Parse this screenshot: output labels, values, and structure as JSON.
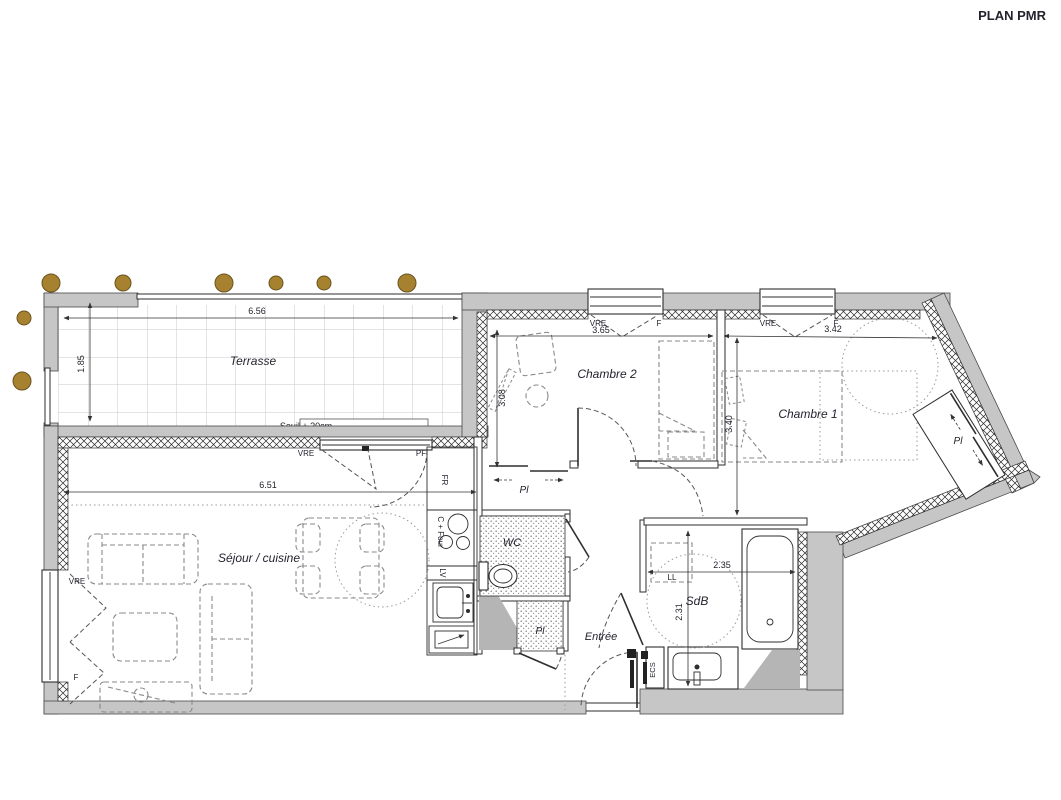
{
  "title": "PLAN PMR",
  "rooms": {
    "terrasse": "Terrasse",
    "chambre2": "Chambre 2",
    "chambre1": "Chambre 1",
    "sejour": "Séjour / cuisine",
    "wc": "WC",
    "sdb": "SdB",
    "entree": "Entrée"
  },
  "labels": {
    "pl": "Pl",
    "vre": "VRE",
    "f": "F",
    "pf": "PF",
    "fr": "FR",
    "cfour": "C + Four",
    "lv": "LV",
    "ll": "LL",
    "ecs": "ECS",
    "seuil": "Seuil + 20cm"
  },
  "dimensions": {
    "terrasse_width": "6.56",
    "terrasse_depth": "1.85",
    "sejour_width": "6.51",
    "chambre2_width": "3.65",
    "chambre2_depth": "3.08",
    "chambre1_width": "3.42",
    "chambre1_depth": "3.40",
    "sdb_width": "2.35",
    "sdb_depth": "2.31"
  },
  "colors": {
    "wall": "#c6c6c6",
    "post": "#a6812f",
    "post_outline": "#6b5320",
    "text": "#23232e"
  }
}
